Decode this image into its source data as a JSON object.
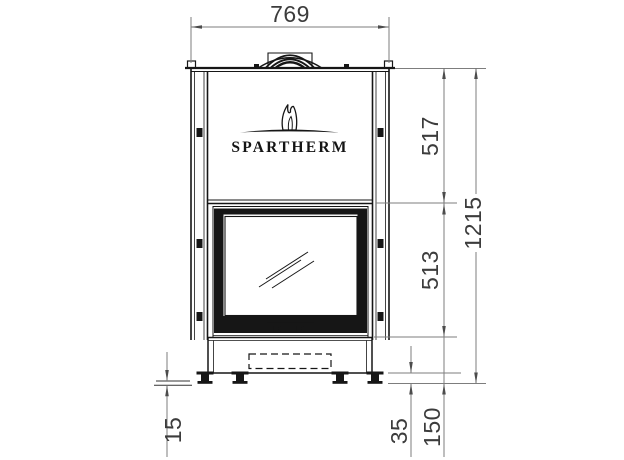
{
  "drawing": {
    "title": "fireplace-front-view-technical-drawing",
    "brand": "SPARTHERM",
    "dimensions_mm": {
      "overall_width": "769",
      "upper_section_height": "517",
      "door_section_height": "513",
      "total_height": "1215",
      "foot_height": "35",
      "base_height": "150",
      "leveling_range": "15"
    },
    "colors": {
      "object_line": "#161616",
      "dimension_line": "#7d7d7d",
      "label_text": "#3c3c3c",
      "background": "#ffffff"
    }
  }
}
